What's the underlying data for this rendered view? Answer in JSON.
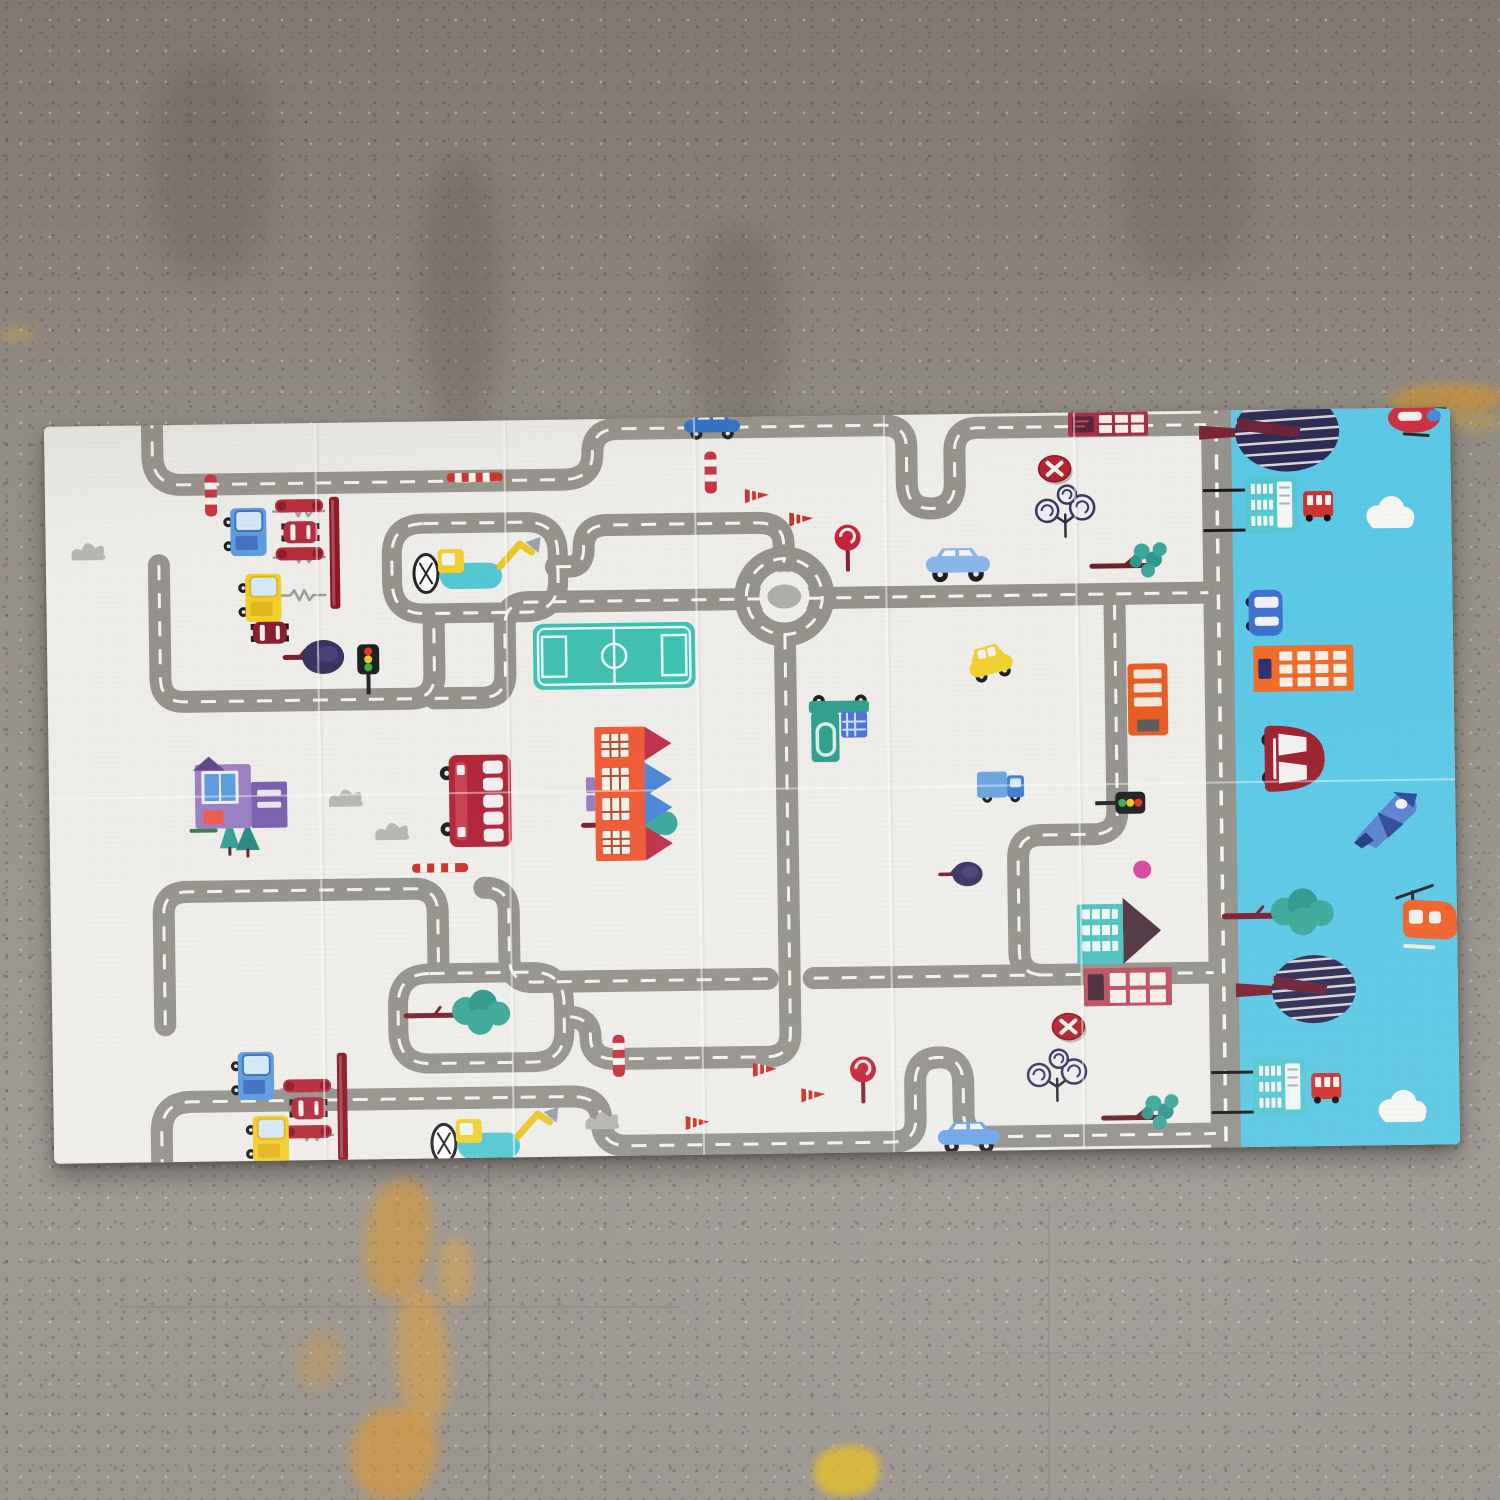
{
  "photo": {
    "subject": "foldable kids play mat with cartoon road map print lying on a speckled concrete floor",
    "floor_base_color": "#989289",
    "floor_top_color": "#80796f",
    "mat_color": "#eeede9",
    "sky_strip_color": "#5ac8e6"
  },
  "palette": {
    "road": "#94928b",
    "dash": "#f4f3ef",
    "mat": "#eeede9",
    "sky": "#5ac8e6",
    "teal": "#3aa89a",
    "tealLight": "#52c8d2",
    "crimson": "#b02437",
    "darkred": "#8f1626",
    "navy": "#2e2c54",
    "orange": "#ee6426",
    "yellow": "#f2cf2a",
    "white": "#f4f3ef",
    "wheel": "#1d1d1f",
    "bushgray": "#b6b5b0"
  },
  "mat_geometry": {
    "x": 49,
    "y": 417,
    "width": 1406,
    "height": 737,
    "rotation_deg": -0.8
  },
  "floor": {
    "dark_streaks": [
      {
        "x": 420,
        "y": 160,
        "w": 80,
        "h": 270,
        "c": "rgba(94,86,76,.35)"
      },
      {
        "x": 690,
        "y": 230,
        "w": 95,
        "h": 200,
        "c": "rgba(90,82,74,.28)"
      },
      {
        "x": 1120,
        "y": 90,
        "w": 130,
        "h": 190,
        "c": "rgba(86,79,71,.22)"
      },
      {
        "x": 150,
        "y": 60,
        "w": 120,
        "h": 220,
        "c": "rgba(86,79,71,.25)"
      }
    ],
    "paint_marks": [
      {
        "x": 366,
        "y": 1178,
        "w": 64,
        "h": 120,
        "c": "#e09a30",
        "o": 0.55,
        "b": 6,
        "r": 8
      },
      {
        "x": 396,
        "y": 1286,
        "w": 52,
        "h": 140,
        "c": "#e8a43a",
        "o": 0.5,
        "b": 7,
        "r": -4
      },
      {
        "x": 352,
        "y": 1408,
        "w": 84,
        "h": 92,
        "c": "#e39a2e",
        "o": 0.6,
        "b": 6,
        "r": 14
      },
      {
        "x": 438,
        "y": 1238,
        "w": 34,
        "h": 66,
        "c": "#edaa3c",
        "o": 0.45,
        "b": 6,
        "r": 0
      },
      {
        "x": 300,
        "y": 1330,
        "w": 40,
        "h": 60,
        "c": "#dd9a35",
        "o": 0.35,
        "b": 8,
        "r": 20
      },
      {
        "x": 814,
        "y": 1446,
        "w": 66,
        "h": 50,
        "c": "#e6c02e",
        "o": 0.8,
        "b": 4,
        "r": -6
      },
      {
        "x": 1390,
        "y": 384,
        "w": 112,
        "h": 30,
        "c": "#d89427",
        "o": 0.6,
        "b": 5,
        "r": -2
      },
      {
        "x": 1448,
        "y": 414,
        "w": 52,
        "h": 16,
        "c": "#e0a637",
        "o": 0.4,
        "b": 5,
        "r": 0
      },
      {
        "x": 0,
        "y": 326,
        "w": 34,
        "h": 16,
        "c": "#d8b14a",
        "o": 0.35,
        "b": 5,
        "r": 0
      }
    ],
    "grooves": [
      {
        "x": 488,
        "y": 1162,
        "w": 2,
        "h": 338,
        "o": 0.08
      },
      {
        "x": 1048,
        "y": 1205,
        "w": 2,
        "h": 295,
        "o": 0.06
      },
      {
        "x": 120,
        "y": 1306,
        "w": 560,
        "h": 2,
        "o": 0.06
      },
      {
        "x": 980,
        "y": 1352,
        "w": 520,
        "h": 2,
        "o": 0.05
      }
    ]
  },
  "scene": {
    "viewbox_w": 1406,
    "viewbox_h": 737,
    "sky": {
      "x": 1186
    },
    "road_width_default": 22,
    "roads": [
      {
        "d": "M108,-12 L108,30 Q108,60 138,60 L518,60 Q548,60 548,34 Q548,10 574,10 L838,10 Q862,10 862,32 L862,68 Q862,94 886,94 Q910,94 910,68 L910,38 Q910,14 934,14 L1162,14",
        "w": 22
      },
      {
        "d": "M113,140 L113,253 Q113,277 137,277 L363,277 Q387,277 387,253 L387,196",
        "w": 22
      },
      {
        "d": "M510,147 L524,147 Q538,147 538,128 Q538,106 562,106 L712,106 Q738,106 738,128 L738,146",
        "w": 22
      },
      {
        "d": "M716,182 L482,182 Q458,182 458,206 L458,253 Q458,277 434,277 L387,277",
        "w": 22
      },
      {
        "d": "M762,182 L1162,182",
        "w": 22
      },
      {
        "d": "M738,218 L738,616 Q738,640 714,640 L562,640 Q538,640 538,618 Q538,597 514,597",
        "w": 22
      },
      {
        "d": "M113,600 L113,489 Q113,467 137,467 L363,467 Q387,467 387,491 L387,548",
        "w": 22
      },
      {
        "d": "M716,562 L482,562 Q458,562 458,538 L458,491 Q458,467 434,467",
        "w": 22
      },
      {
        "d": "M762,562 L1162,562",
        "w": 22
      },
      {
        "d": "M1068,193 L1068,398 Q1068,422 1044,422 L992,422 Q968,422 968,446 L968,538 Q968,562 992,562",
        "w": 22
      },
      {
        "d": "M108,749 L108,707 Q108,677 138,677 L518,677 Q548,677 548,703 Q548,727 574,727 L838,727 Q862,727 862,705 L862,669 Q862,643 886,643 Q910,643 910,669 L910,699 Q910,723 934,723 L1162,723",
        "w": 22
      },
      {
        "d": "M378,102 L480,102 Q512,102 512,134 L512,160 Q512,192 480,192 L378,192 Q346,192 346,160 L346,134 Q346,102 378,102 Z",
        "w": 20
      },
      {
        "d": "M378,552 L480,552 Q512,552 512,584 L512,610 Q512,642 480,642 L378,642 Q346,642 346,610 L346,584 Q346,552 378,552 Z",
        "w": 20
      },
      {
        "d": "M1172,-12 L1172,749",
        "w": 30
      }
    ],
    "roundabout": {
      "cx": 738,
      "cy": 180,
      "r": 38
    },
    "seams": {
      "vertical_x": [
        271,
        460,
        650,
        840,
        1030
      ],
      "horizontal_y": [
        372
      ]
    },
    "items": [
      {
        "type": "field",
        "x": 486,
        "y": 204,
        "w": 162,
        "h": 66
      },
      {
        "type": "gateline",
        "x": 228,
        "y": 88
      },
      {
        "type": "gateline",
        "x": 228,
        "y": 134
      },
      {
        "type": "gateline",
        "x": 228,
        "y": 172
      },
      {
        "type": "gateline",
        "x": 228,
        "y": 666
      },
      {
        "type": "gateline",
        "x": 228,
        "y": 712
      },
      {
        "type": "gateline",
        "x": 228,
        "y": 748
      },
      {
        "type": "wall",
        "x": 284,
        "y": 74,
        "h": 112
      },
      {
        "type": "wall",
        "x": 284,
        "y": 630,
        "h": 108
      },
      {
        "type": "rail",
        "x": 230,
        "y": 76
      },
      {
        "type": "rail",
        "x": 230,
        "y": 124
      },
      {
        "type": "rail",
        "x": 230,
        "y": 656
      },
      {
        "type": "rail",
        "x": 230,
        "y": 702
      },
      {
        "type": "truck",
        "x": 182,
        "y": 84,
        "c": "#5b9be0",
        "c2": "#3f6fc0"
      },
      {
        "type": "truck",
        "x": 182,
        "y": 628,
        "c": "#5b9be0",
        "c2": "#3f6fc0"
      },
      {
        "type": "truck",
        "x": 196,
        "y": 150,
        "c": "#f2cf2a",
        "c2": "#e0b820"
      },
      {
        "type": "truck",
        "x": 196,
        "y": 692,
        "c": "#f2cf2a",
        "c2": "#e0b820"
      },
      {
        "type": "carTop",
        "x": 238,
        "y": 98,
        "c": "#b5283c"
      },
      {
        "type": "carTop",
        "x": 238,
        "y": 674,
        "c": "#b5283c"
      },
      {
        "type": "carTop",
        "x": 206,
        "y": 198,
        "c": "#8a1f2e"
      },
      {
        "type": "treeRound",
        "x": 266,
        "y": 234,
        "s": 1
      },
      {
        "type": "treeRound",
        "x": 910,
        "y": 460,
        "s": 0.72
      },
      {
        "type": "excavator",
        "x": 368,
        "y": 112
      },
      {
        "type": "excavator",
        "x": 378,
        "y": 682
      },
      {
        "type": "treeBlob",
        "x": 390,
        "y": 580,
        "w": 1,
        "trunk": 36
      },
      {
        "type": "treeBlob",
        "x": 560,
        "y": 392,
        "w": 1,
        "trunk": 26
      },
      {
        "type": "treeBranch",
        "x": 1046,
        "y": 148
      },
      {
        "type": "treeBranch",
        "x": 1050,
        "y": 700
      },
      {
        "type": "treeSwirl",
        "x": 1020,
        "y": 96
      },
      {
        "type": "treeSwirl",
        "x": 1004,
        "y": 660
      },
      {
        "type": "treeCone",
        "x": 170,
        "y": 394
      },
      {
        "type": "bush",
        "x": 26,
        "y": 116
      },
      {
        "type": "bush",
        "x": 280,
        "y": 366
      },
      {
        "type": "bush",
        "x": 326,
        "y": 400
      },
      {
        "type": "bush",
        "x": 532,
        "y": 692
      },
      {
        "type": "houseRed",
        "x": 546,
        "y": 308,
        "flip": false
      },
      {
        "type": "houseRed",
        "x": 546,
        "y": 372,
        "flip": true
      },
      {
        "type": "housePurple",
        "x": 146,
        "y": 336
      },
      {
        "type": "houseTeal",
        "x": 1026,
        "y": 486
      },
      {
        "type": "bldgPink",
        "x": 1032,
        "y": 556
      },
      {
        "type": "booth",
        "x": 1024,
        "y": 0
      },
      {
        "type": "ddbus",
        "x": 398,
        "y": 334
      },
      {
        "type": "busOrange",
        "x": 1080,
        "y": 252
      },
      {
        "type": "garbage",
        "x": 761,
        "y": 282
      },
      {
        "type": "car",
        "x": 640,
        "y": -4,
        "w": 56,
        "h": 20,
        "c": "#2e6fc8"
      },
      {
        "type": "car",
        "x": 880,
        "y": 134,
        "w": 64,
        "h": 26,
        "c": "#8ab6ea"
      },
      {
        "type": "car",
        "x": 884,
        "y": 708,
        "w": 62,
        "h": 24,
        "c": "#6aa7e8"
      },
      {
        "type": "taxi",
        "x": 918,
        "y": 240
      },
      {
        "type": "truckH",
        "x": 928,
        "y": 354
      },
      {
        "type": "light",
        "x": 310,
        "y": 222,
        "rot": 0
      },
      {
        "type": "light",
        "x": 1096,
        "y": 380,
        "rot": 90
      },
      {
        "type": "stop",
        "x": 790,
        "y": 112
      },
      {
        "type": "stop",
        "x": 798,
        "y": 644
      },
      {
        "type": "noentry",
        "x": 1010,
        "y": 56
      },
      {
        "type": "noentry",
        "x": 1016,
        "y": 614
      },
      {
        "type": "cone",
        "x": 700,
        "y": 70
      },
      {
        "type": "cone",
        "x": 744,
        "y": 94
      },
      {
        "type": "cone",
        "x": 632,
        "y": 696
      },
      {
        "type": "cone",
        "x": 700,
        "y": 644
      },
      {
        "type": "cone",
        "x": 748,
        "y": 670
      },
      {
        "type": "coneH",
        "x": 402,
        "y": 52
      },
      {
        "type": "coneH",
        "x": 362,
        "y": 442
      },
      {
        "type": "barrierV",
        "x": 160,
        "y": 50
      },
      {
        "type": "barrierV",
        "x": 560,
        "y": 616
      },
      {
        "type": "barrierV",
        "x": 660,
        "y": 34
      },
      {
        "type": "dot",
        "x": 1092,
        "y": 458,
        "c": "#d8459a"
      },
      {
        "type": "treeStriped",
        "x": 1243,
        "y": 22,
        "rx": 52,
        "ry": 40
      },
      {
        "type": "treeStriped",
        "x": 1262,
        "y": 580,
        "rx": 42,
        "ry": 34
      },
      {
        "type": "pole",
        "x": 1158,
        "y": 80,
        "len": 46
      },
      {
        "type": "pole",
        "x": 1158,
        "y": 120,
        "len": 46
      },
      {
        "type": "pole",
        "x": 1158,
        "y": 662,
        "len": 46
      },
      {
        "type": "pole",
        "x": 1158,
        "y": 702,
        "len": 46
      },
      {
        "type": "busstop",
        "x": 1200,
        "y": 66
      },
      {
        "type": "busstop",
        "x": 1200,
        "y": 648
      },
      {
        "type": "cloud",
        "x": 1322,
        "y": 96
      },
      {
        "type": "cloud",
        "x": 1326,
        "y": 690
      },
      {
        "type": "carSide",
        "x": 1202,
        "y": 180
      },
      {
        "type": "bldgOrange",
        "x": 1206,
        "y": 236
      },
      {
        "type": "carRed",
        "x": 1212,
        "y": 316
      },
      {
        "type": "jet",
        "x": 1304,
        "y": 378
      },
      {
        "type": "truckOrange",
        "x": 1180,
        "y": 396
      },
      {
        "type": "treeBlobH",
        "x": 1216,
        "y": 492
      },
      {
        "type": "heliOrange",
        "x": 1352,
        "y": 486
      },
      {
        "type": "heliRed",
        "x": 1368,
        "y": -4
      }
    ]
  }
}
